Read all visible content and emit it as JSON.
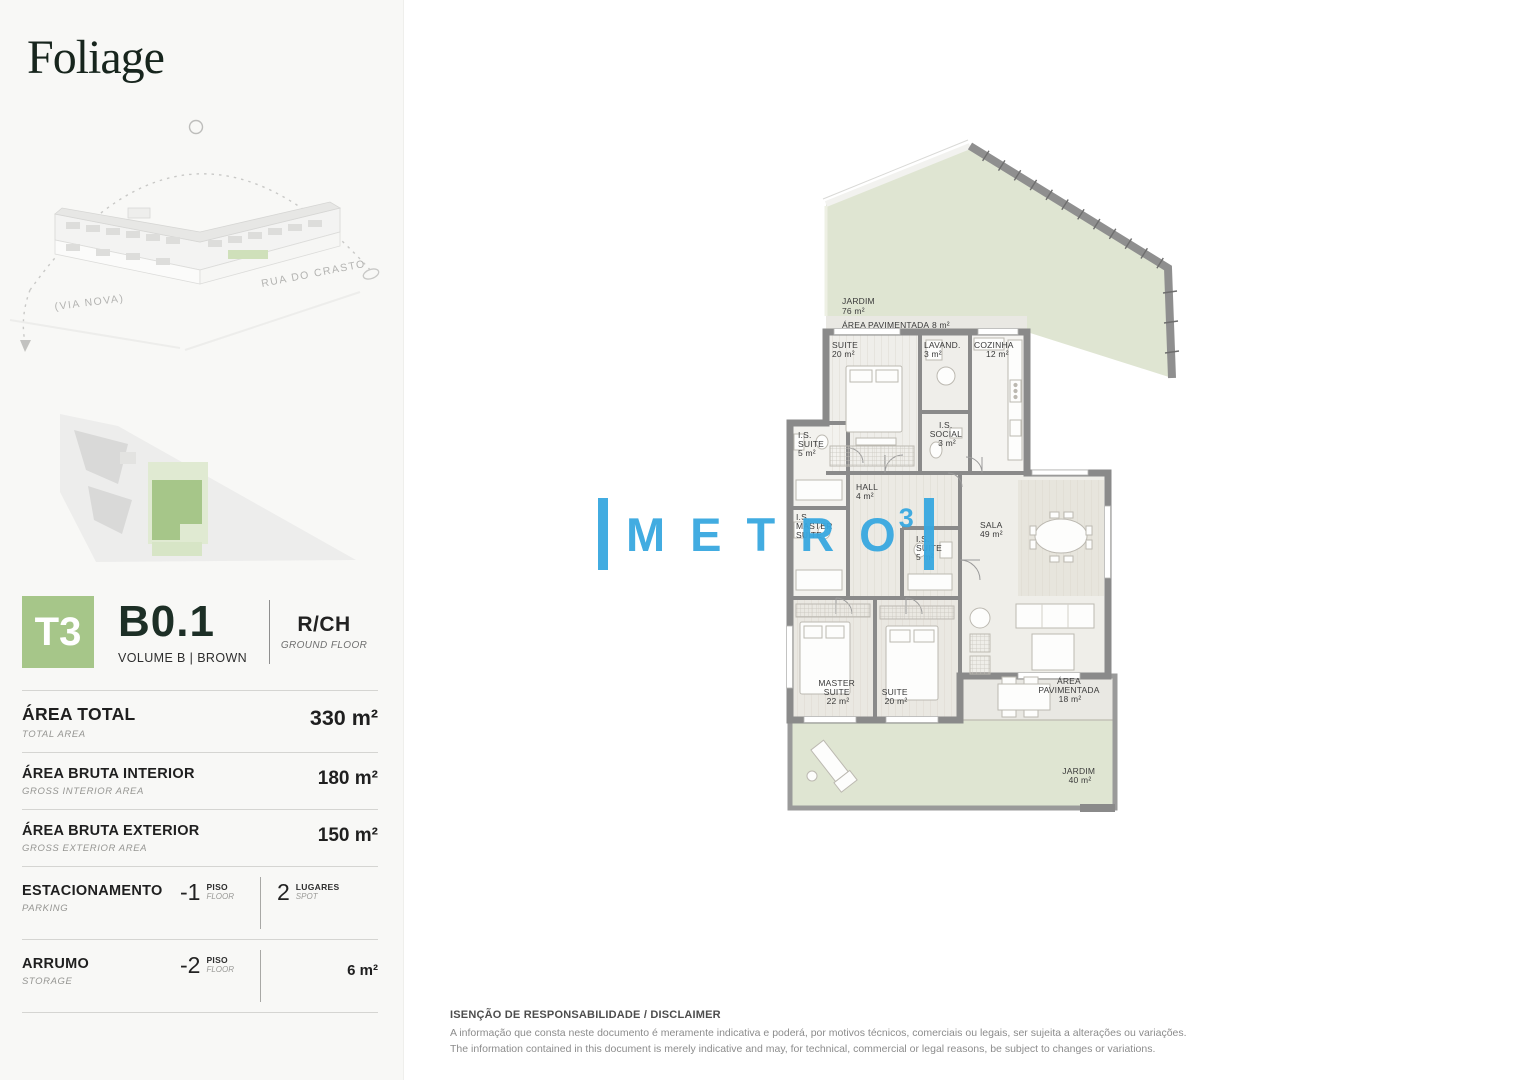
{
  "brand": {
    "logo_text": "Foliage"
  },
  "location_sketch": {
    "street_left": "(VIA NOVA)",
    "street_right": "RUA DO CRASTO"
  },
  "unit": {
    "typology": "T3",
    "code": "B0.1",
    "volume": "VOLUME B | BROWN",
    "floor_code": "R/CH",
    "floor_name": "GROUND FLOOR"
  },
  "metrics": {
    "rows": [
      {
        "label": "ÁREA TOTAL",
        "sublabel": "TOTAL AREA",
        "value": "330 m²"
      },
      {
        "label": "ÁREA BRUTA INTERIOR",
        "sublabel": "GROSS INTERIOR AREA",
        "value": "180 m²"
      },
      {
        "label": "ÁREA BRUTA EXTERIOR",
        "sublabel": "GROSS EXTERIOR AREA",
        "value": "150 m²"
      }
    ],
    "parking": {
      "label": "ESTACIONAMENTO",
      "sublabel": "PARKING",
      "floor_value": "-1",
      "floor_unit": "PISO",
      "floor_unit_sub": "FLOOR",
      "spots_value": "2",
      "spots_unit": "LUGARES",
      "spots_unit_sub": "SPOT"
    },
    "storage": {
      "label": "ARRUMO",
      "sublabel": "STORAGE",
      "floor_value": "-2",
      "floor_unit": "PISO",
      "floor_unit_sub": "FLOOR",
      "value": "6 m²"
    }
  },
  "plan": {
    "rooms": {
      "jardim_top": {
        "name": "JARDIM",
        "area": "76 m²"
      },
      "paved_top": {
        "name": "ÁREA PAVIMENTADA",
        "area": "8 m²"
      },
      "suite_top": {
        "name": "SUITE",
        "area": "20 m²"
      },
      "lavand": {
        "name": "LAVAND.",
        "area": "3 m²"
      },
      "cozinha": {
        "name": "COZINHA",
        "area": "12 m²"
      },
      "is_social": {
        "name1": "I.S.",
        "name2": "SOCIAL",
        "area": "3 m²"
      },
      "is_suite_left": {
        "name1": "I.S.",
        "name2": "SUITE",
        "area": "5 m²"
      },
      "hall": {
        "name": "HALL",
        "area": "4 m²"
      },
      "is_master": {
        "name1": "I.S.",
        "name2": "MASTER",
        "name3": "SUITE"
      },
      "is_suite_mid": {
        "name1": "I.S.",
        "name2": "SUITE",
        "area": "5 m²"
      },
      "sala": {
        "name": "SALA",
        "area": "49 m²"
      },
      "master_suite": {
        "name1": "MASTER",
        "name2": "SUITE",
        "area": "22 m²"
      },
      "suite_bottom": {
        "name": "SUITE",
        "area": "20 m²"
      },
      "paved_bottom": {
        "name1": "ÁREA",
        "name2": "PAVIMENTADA",
        "area": "18 m²"
      },
      "jardim_bottom": {
        "name": "JARDIM",
        "area": "40 m²"
      }
    }
  },
  "watermark": {
    "word": "METRO",
    "superscript": "3"
  },
  "disclaimer": {
    "title": "ISENÇÃO DE RESPONSABILIDADE / DISCLAIMER",
    "line_pt": "A informação que consta neste documento é meramente indicativa e poderá, por motivos técnicos, comerciais ou legais, ser sujeita a alterações ou variações.",
    "line_en": "The information contained in this document is merely indicative and may, for technical, commercial or legal reasons, be subject to changes or variations."
  },
  "colors": {
    "accent_green": "#a6c689",
    "garden_green": "#dfe5d2",
    "paving_gray": "#e9e8e3",
    "wall_gray": "#8a8a8a",
    "watermark_cyan": "#38a8e0"
  }
}
